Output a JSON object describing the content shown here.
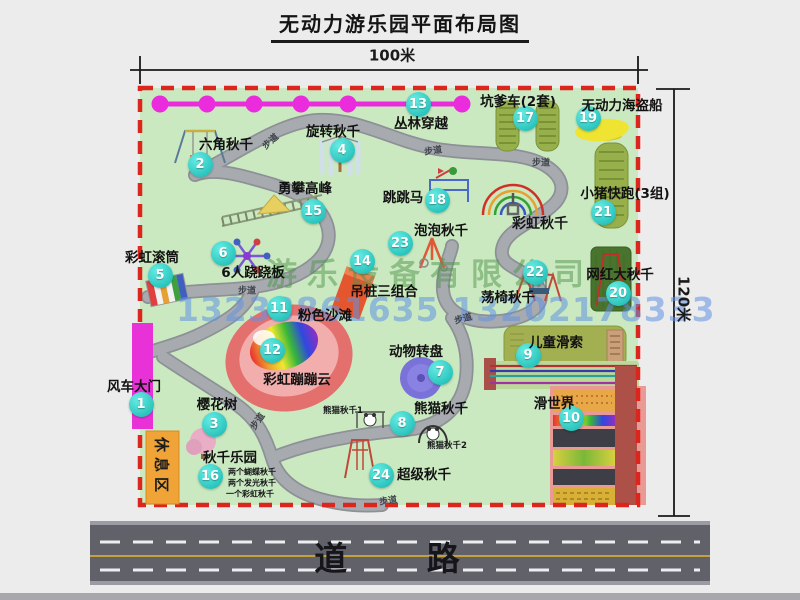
{
  "page": {
    "title": "无动力游乐园平面布局图"
  },
  "dimensions": {
    "width_label": "100米",
    "height_label": "120米"
  },
  "road": {
    "label": "道 路"
  },
  "watermark": {
    "company": "游乐设备有限公司",
    "phone": "13233861635 13202178333"
  },
  "park": {
    "rest_area_label": "休息区",
    "gate_label": "风车大门",
    "walkway_label": "步道",
    "walkway_label_positions": [
      {
        "x": 270,
        "y": 141,
        "rot": -42
      },
      {
        "x": 433,
        "y": 150,
        "rot": -8
      },
      {
        "x": 541,
        "y": 162,
        "rot": 0
      },
      {
        "x": 463,
        "y": 318,
        "rot": -15
      },
      {
        "x": 247,
        "y": 290,
        "rot": 0
      },
      {
        "x": 257,
        "y": 421,
        "rot": -55
      },
      {
        "x": 388,
        "y": 500,
        "rot": -8
      }
    ],
    "items": [
      {
        "num": "1",
        "label": "风车大门",
        "bx": 141,
        "by": 404,
        "lx": -1000,
        "ly": -1000
      },
      {
        "num": "2",
        "label": "六角秋千",
        "bx": 200,
        "by": 164,
        "lx": 226,
        "ly": 143
      },
      {
        "num": "3",
        "label": "樱花树",
        "bx": 214,
        "by": 424,
        "lx": 217,
        "ly": 403
      },
      {
        "num": "4",
        "label": "旋转秋千",
        "bx": 342,
        "by": 150,
        "lx": 333,
        "ly": 130
      },
      {
        "num": "5",
        "label": "彩虹滚筒",
        "bx": 160,
        "by": 275,
        "lx": 152,
        "ly": 256
      },
      {
        "num": "6",
        "label": "6人跷跷板",
        "bx": 223,
        "by": 253,
        "lx": 253,
        "ly": 271
      },
      {
        "num": "7",
        "label": "动物转盘",
        "bx": 440,
        "by": 372,
        "lx": 416,
        "ly": 350
      },
      {
        "num": "8",
        "label": "熊猫秋千",
        "bx": 402,
        "by": 423,
        "lx": 441,
        "ly": 407
      },
      {
        "num": "9",
        "label": "儿童滑索",
        "bx": 528,
        "by": 355,
        "lx": 556,
        "ly": 341
      },
      {
        "num": "10",
        "label": "滑世界",
        "bx": 571,
        "by": 418,
        "lx": 554,
        "ly": 402
      },
      {
        "num": "11",
        "label": "粉色沙滩",
        "bx": 279,
        "by": 308,
        "lx": 325,
        "ly": 314
      },
      {
        "num": "12",
        "label": "彩虹蹦蹦云",
        "bx": 272,
        "by": 350,
        "lx": 297,
        "ly": 378
      },
      {
        "num": "13",
        "label": "丛林穿越",
        "bx": 418,
        "by": 104,
        "lx": 421,
        "ly": 122
      },
      {
        "num": "14",
        "label": "吊桩三组合",
        "bx": 362,
        "by": 261,
        "lx": 384,
        "ly": 290
      },
      {
        "num": "15",
        "label": "勇攀高峰",
        "bx": 313,
        "by": 211,
        "lx": 305,
        "ly": 187
      },
      {
        "num": "16",
        "label": "秋千乐园",
        "bx": 210,
        "by": 476,
        "lx": 230,
        "ly": 456
      },
      {
        "num": "17",
        "label": "坑爹车(2套)",
        "bx": 525,
        "by": 118,
        "lx": 518,
        "ly": 100
      },
      {
        "num": "18",
        "label": "跳跳马",
        "bx": 437,
        "by": 200,
        "lx": 403,
        "ly": 196
      },
      {
        "num": "19",
        "label": "无动力海盗船",
        "bx": 588,
        "by": 118,
        "lx": 622,
        "ly": 104
      },
      {
        "num": "20",
        "label": "网红大秋千",
        "bx": 618,
        "by": 293,
        "lx": 620,
        "ly": 273
      },
      {
        "num": "21",
        "label": "小猪快跑(3组)",
        "bx": 603,
        "by": 212,
        "lx": 625,
        "ly": 192
      },
      {
        "num": "22",
        "label": "荡椅秋千",
        "bx": 535,
        "by": 272,
        "lx": 508,
        "ly": 296
      },
      {
        "num": "23",
        "label": "泡泡秋千",
        "bx": 400,
        "by": 243,
        "lx": 441,
        "ly": 229
      },
      {
        "num": "24",
        "label": "超级秋千",
        "bx": 381,
        "by": 475,
        "lx": 424,
        "ly": 473
      }
    ],
    "extra_labels": [
      {
        "text": "彩虹秋千",
        "x": 540,
        "y": 223,
        "size": 14
      },
      {
        "text": "熊猫秋千1",
        "x": 343,
        "y": 410,
        "size": 8.5
      },
      {
        "text": "熊猫秋千2",
        "x": 447,
        "y": 445,
        "size": 8.5
      },
      {
        "text": "两个蝴蝶秋千",
        "x": 252,
        "y": 472,
        "size": 8
      },
      {
        "text": "两个发光秋千",
        "x": 252,
        "y": 483,
        "size": 8
      },
      {
        "text": "一个彩虹秋千",
        "x": 250,
        "y": 494,
        "size": 8
      }
    ],
    "colors": {
      "park_green": "#cbe9c1",
      "border_red": "#dc251c",
      "badge_teal": "#2cc6be",
      "magenta": "#e832d8",
      "rest_orange": "#f0a336",
      "road_gray": "#61616a"
    }
  }
}
